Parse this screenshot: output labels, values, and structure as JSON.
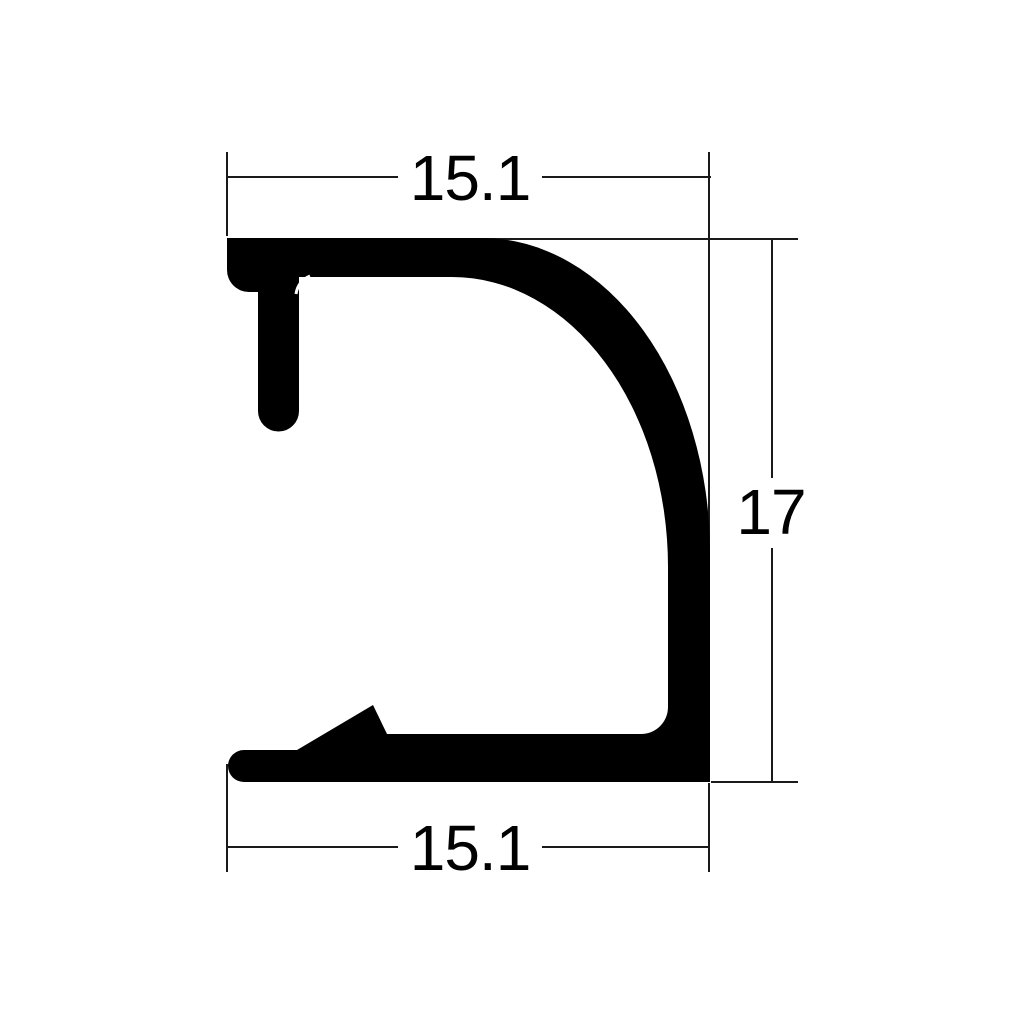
{
  "drawing": {
    "background_color": "#ffffff",
    "profile_color": "#000000",
    "dimension_line_color": "#1a1a1a",
    "dimensions": {
      "top_width": "15.1",
      "height": "17",
      "bottom_width": "15.1"
    }
  }
}
